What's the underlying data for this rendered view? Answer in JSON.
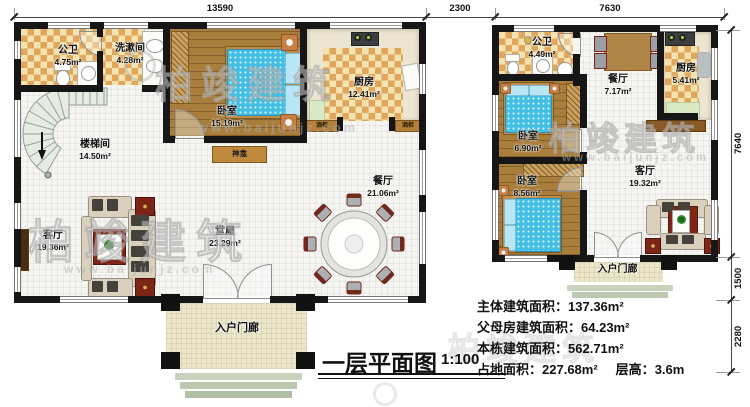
{
  "watermark": {
    "brand": "柏竣建筑",
    "site": "www.baijunjz.com"
  },
  "dims": {
    "top": [
      "13590",
      "2300",
      "7630"
    ],
    "right": [
      "7640",
      "1500",
      "2280"
    ]
  },
  "title": {
    "text": "一层平面图",
    "scale": "1:100"
  },
  "info": {
    "lines": [
      {
        "label": "主体建筑面积：",
        "value": "137.36m²"
      },
      {
        "label": "父母房建筑面积：",
        "value": "64.23m²"
      },
      {
        "label": "本栋建筑面积：",
        "value": "562.71m²"
      },
      {
        "label": "占地面积：",
        "value": "227.68m²",
        "label2": "层高：",
        "value2": "3.6m"
      }
    ]
  },
  "main": {
    "rooms": {
      "bath": {
        "name": "公卫",
        "area": "4.75m²"
      },
      "wash": {
        "name": "洗漱间",
        "area": "4.28m²"
      },
      "bedroom": {
        "name": "卧室",
        "area": "15.19m²"
      },
      "kitchen": {
        "name": "厨房",
        "area": "12.41m²"
      },
      "stair": {
        "name": "楼梯间",
        "area": "14.50m²"
      },
      "living": {
        "name": "客厅",
        "area": "19.36m²"
      },
      "hall": {
        "name": "堂屋",
        "area": "23.29m²"
      },
      "dining": {
        "name": "餐厅",
        "area": "21.06m²"
      },
      "porch": {
        "name": "入户门廊"
      },
      "shrine": {
        "name": "神龛"
      },
      "wine": {
        "name": "酒柜"
      }
    }
  },
  "parents": {
    "rooms": {
      "bath": {
        "name": "公卫",
        "area": "4.49m²"
      },
      "dining": {
        "name": "餐厅",
        "area": "7.17m²"
      },
      "kitchen": {
        "name": "厨房",
        "area": "5.41m²"
      },
      "bed1": {
        "name": "卧室",
        "area": "6.90m²"
      },
      "bed2": {
        "name": "卧室",
        "area": "8.56m²"
      },
      "living": {
        "name": "客厅",
        "area": "19.32m²"
      },
      "porch": {
        "name": "入户门廊"
      }
    }
  },
  "colors": {
    "wall": "#161616",
    "checker_dark": "#dfa65c",
    "checker_light": "#f4e2b0",
    "wood": "#a97e3d",
    "bed_quilt": "#43bfe4",
    "accent_red": "#7c2416",
    "stair_fill": "#e6ece3",
    "porch_floor": "#ebe6c7"
  }
}
